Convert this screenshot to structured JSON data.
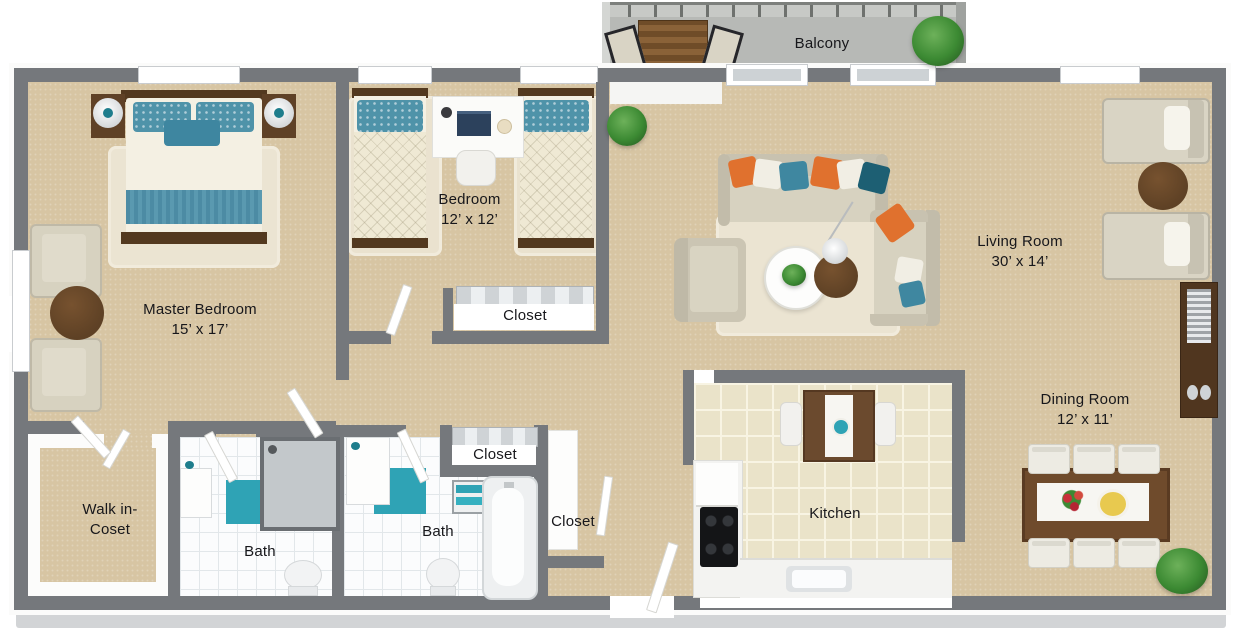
{
  "palette": {
    "wall": "#75787c",
    "carpet": "#d7c5a3",
    "kitchen_tile": "#eae3c9",
    "bath_tile": "#fbfcfd",
    "balcony_floor": "#b7b9b6",
    "accent_teal": "#2fa3b5",
    "accent_orange": "#e0712e",
    "wood": "#6b4a2e"
  },
  "rooms": {
    "balcony": {
      "name": "Balcony"
    },
    "master_bedroom": {
      "name": "Master Bedroom",
      "size": "15’ x 17’"
    },
    "bedroom": {
      "name": "Bedroom",
      "size": "12’ x 12’"
    },
    "living_room": {
      "name": "Living Room",
      "size": "30’ x 14’"
    },
    "dining_room": {
      "name": "Dining Room",
      "size": "12’ x 11’"
    },
    "kitchen": {
      "name": "Kitchen"
    },
    "walk_in_closet": {
      "name_line1": "Walk in-",
      "name_line2": "Coset"
    },
    "bath_1": {
      "name": "Bath"
    },
    "bath_2": {
      "name": "Bath"
    },
    "closet_bedroom": {
      "name": "Closet"
    },
    "closet_hall": {
      "name": "Closet"
    },
    "closet_entry": {
      "name": "Closet"
    }
  }
}
